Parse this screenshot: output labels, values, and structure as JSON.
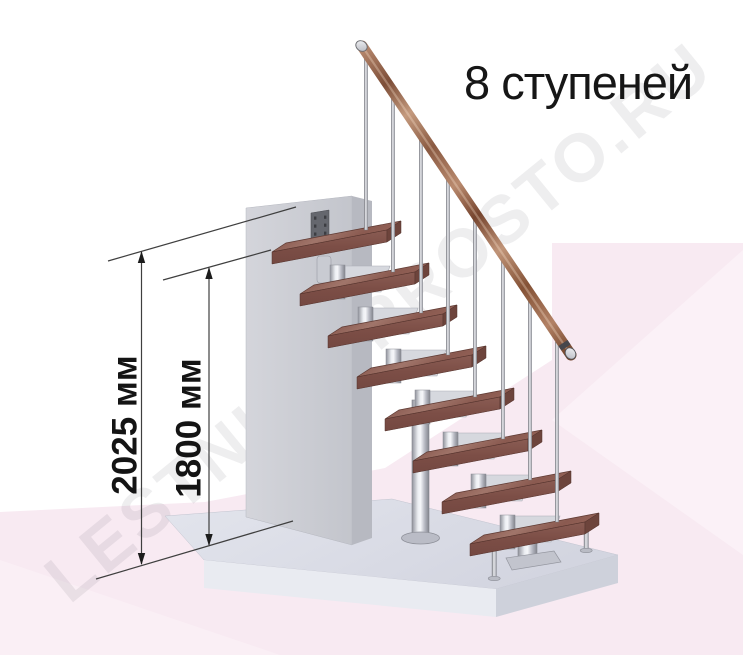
{
  "title": "8 ступеней",
  "steps_count": 8,
  "dimensions": [
    {
      "id": "total-height",
      "label": "2025 мм"
    },
    {
      "id": "tread-height",
      "label": "1800 мм"
    }
  ],
  "watermark": {
    "text": "LESTNICA-PROSTO.RU"
  },
  "units": "мм",
  "colors": {
    "background": "#ffffff",
    "background_pink": "#f8eaf2",
    "background_pink_light": "#fbf1f7",
    "floor_slab_top": "#dcdee8",
    "floor_slab_front": "#e9ebf1",
    "wall_front": "#cdced5",
    "tread_wood": "#8f6057",
    "handrail_wood": "#b98a6f",
    "metal": "#c9cbd3",
    "dimension_line": "#3f3f3f",
    "title_text": "#161616"
  }
}
